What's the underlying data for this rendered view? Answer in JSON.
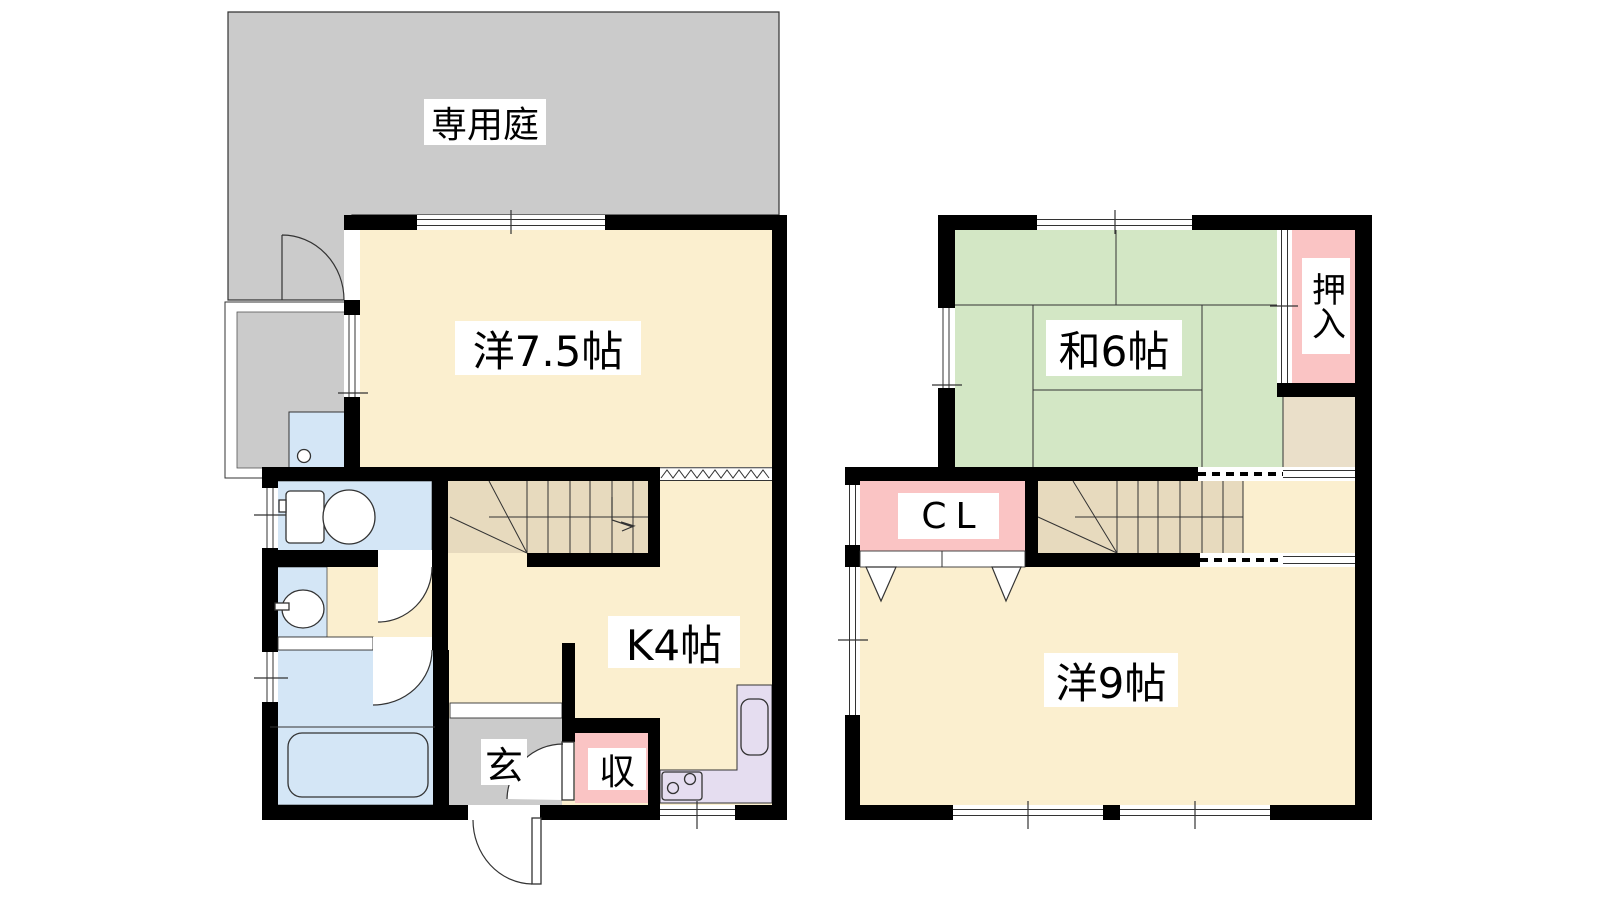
{
  "palette": {
    "wall": "#000000",
    "cream": "#FBEFCF",
    "green": "#D3E7C5",
    "pink": "#FAC4C4",
    "blue": "#D4E6F6",
    "lavender": "#E5DDF0",
    "tan": "#E7DABE",
    "tan_light": "#EADFC9",
    "gray": "#CBCBCB",
    "outline": "#333333"
  },
  "floor1": {
    "garden": "専用庭",
    "western_room": "洋7.5帖",
    "kitchen": "K4帖",
    "entrance": "玄",
    "storage": "収"
  },
  "floor2": {
    "japanese_room": "和6帖",
    "oshiire": "押入",
    "closet": "CL",
    "western_room": "洋9帖"
  }
}
